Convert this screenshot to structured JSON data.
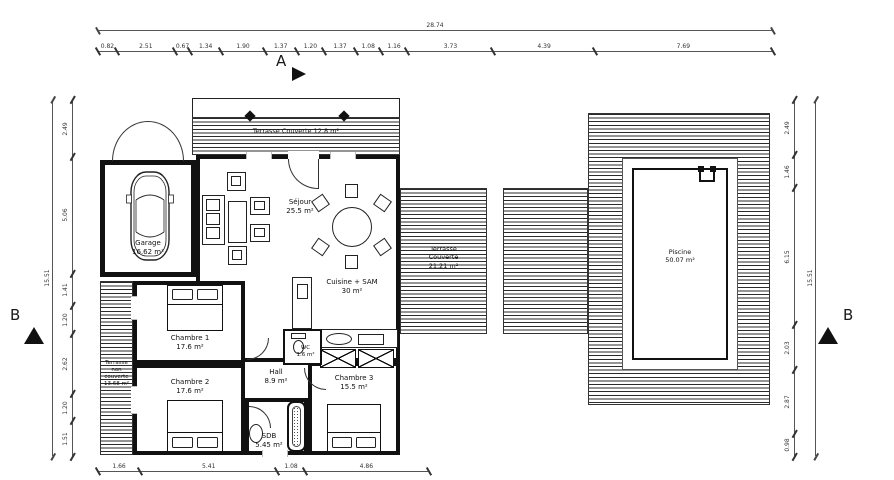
{
  "colors": {
    "ink": "#111111",
    "dimension_line": "#555555",
    "background": "#ffffff"
  },
  "section_markers": {
    "a": "A",
    "b_left": "B",
    "b_right": "B"
  },
  "dimensions": {
    "top_total": "28.74",
    "top_segments": [
      "0.82",
      "2.51",
      "0.67",
      "1.34",
      "1.90",
      "1.37",
      "1.20",
      "1.37",
      "1.08",
      "1.16",
      "3.73",
      "4.39",
      "7.69"
    ],
    "bottom_segments": [
      "1.66",
      "5.41",
      "1.08",
      "4.86"
    ],
    "left_total": "15.51",
    "left_segments": [
      "2.49",
      "5.06",
      "1.41",
      "1.20",
      "2.62",
      "1.20",
      "1.51"
    ],
    "right_total": "15.51",
    "right_segments": [
      "2.49",
      "1.46",
      "6.15",
      "2.03",
      "2.87",
      "0.98"
    ]
  },
  "rooms": {
    "terrasse_couverte_top": {
      "name": "Terrasse Couverte",
      "area": "12.8 m²"
    },
    "garage": {
      "name": "Garage",
      "area": "16.62 m²"
    },
    "sejour": {
      "name": "Séjour",
      "area": "25.5 m²"
    },
    "cuisine": {
      "name": "Cuisine + SAM",
      "area": "30 m²"
    },
    "terrasse_couverte_right": {
      "line1": "Terrasse",
      "line2": "Couverte",
      "area": "21.21 m²"
    },
    "piscine": {
      "name": "Piscine",
      "area": "50.07 m²"
    },
    "chambre1": {
      "name": "Chambre 1",
      "area": "17.6 m²"
    },
    "chambre2": {
      "name": "Chambre 2",
      "area": "17.6 m²"
    },
    "chambre3": {
      "name": "Chambre 3",
      "area": "15.5 m²"
    },
    "hall": {
      "name": "Hall",
      "area": "8.9 m²"
    },
    "wc": {
      "name": "WC",
      "area": "1.6 m²"
    },
    "sdb": {
      "name": "SDB",
      "area": "5.45 m²"
    },
    "terrasse_non_couverte": {
      "line1": "Terrasse",
      "line2": "non",
      "line3": "couverte",
      "area": "13.68 m²"
    }
  }
}
